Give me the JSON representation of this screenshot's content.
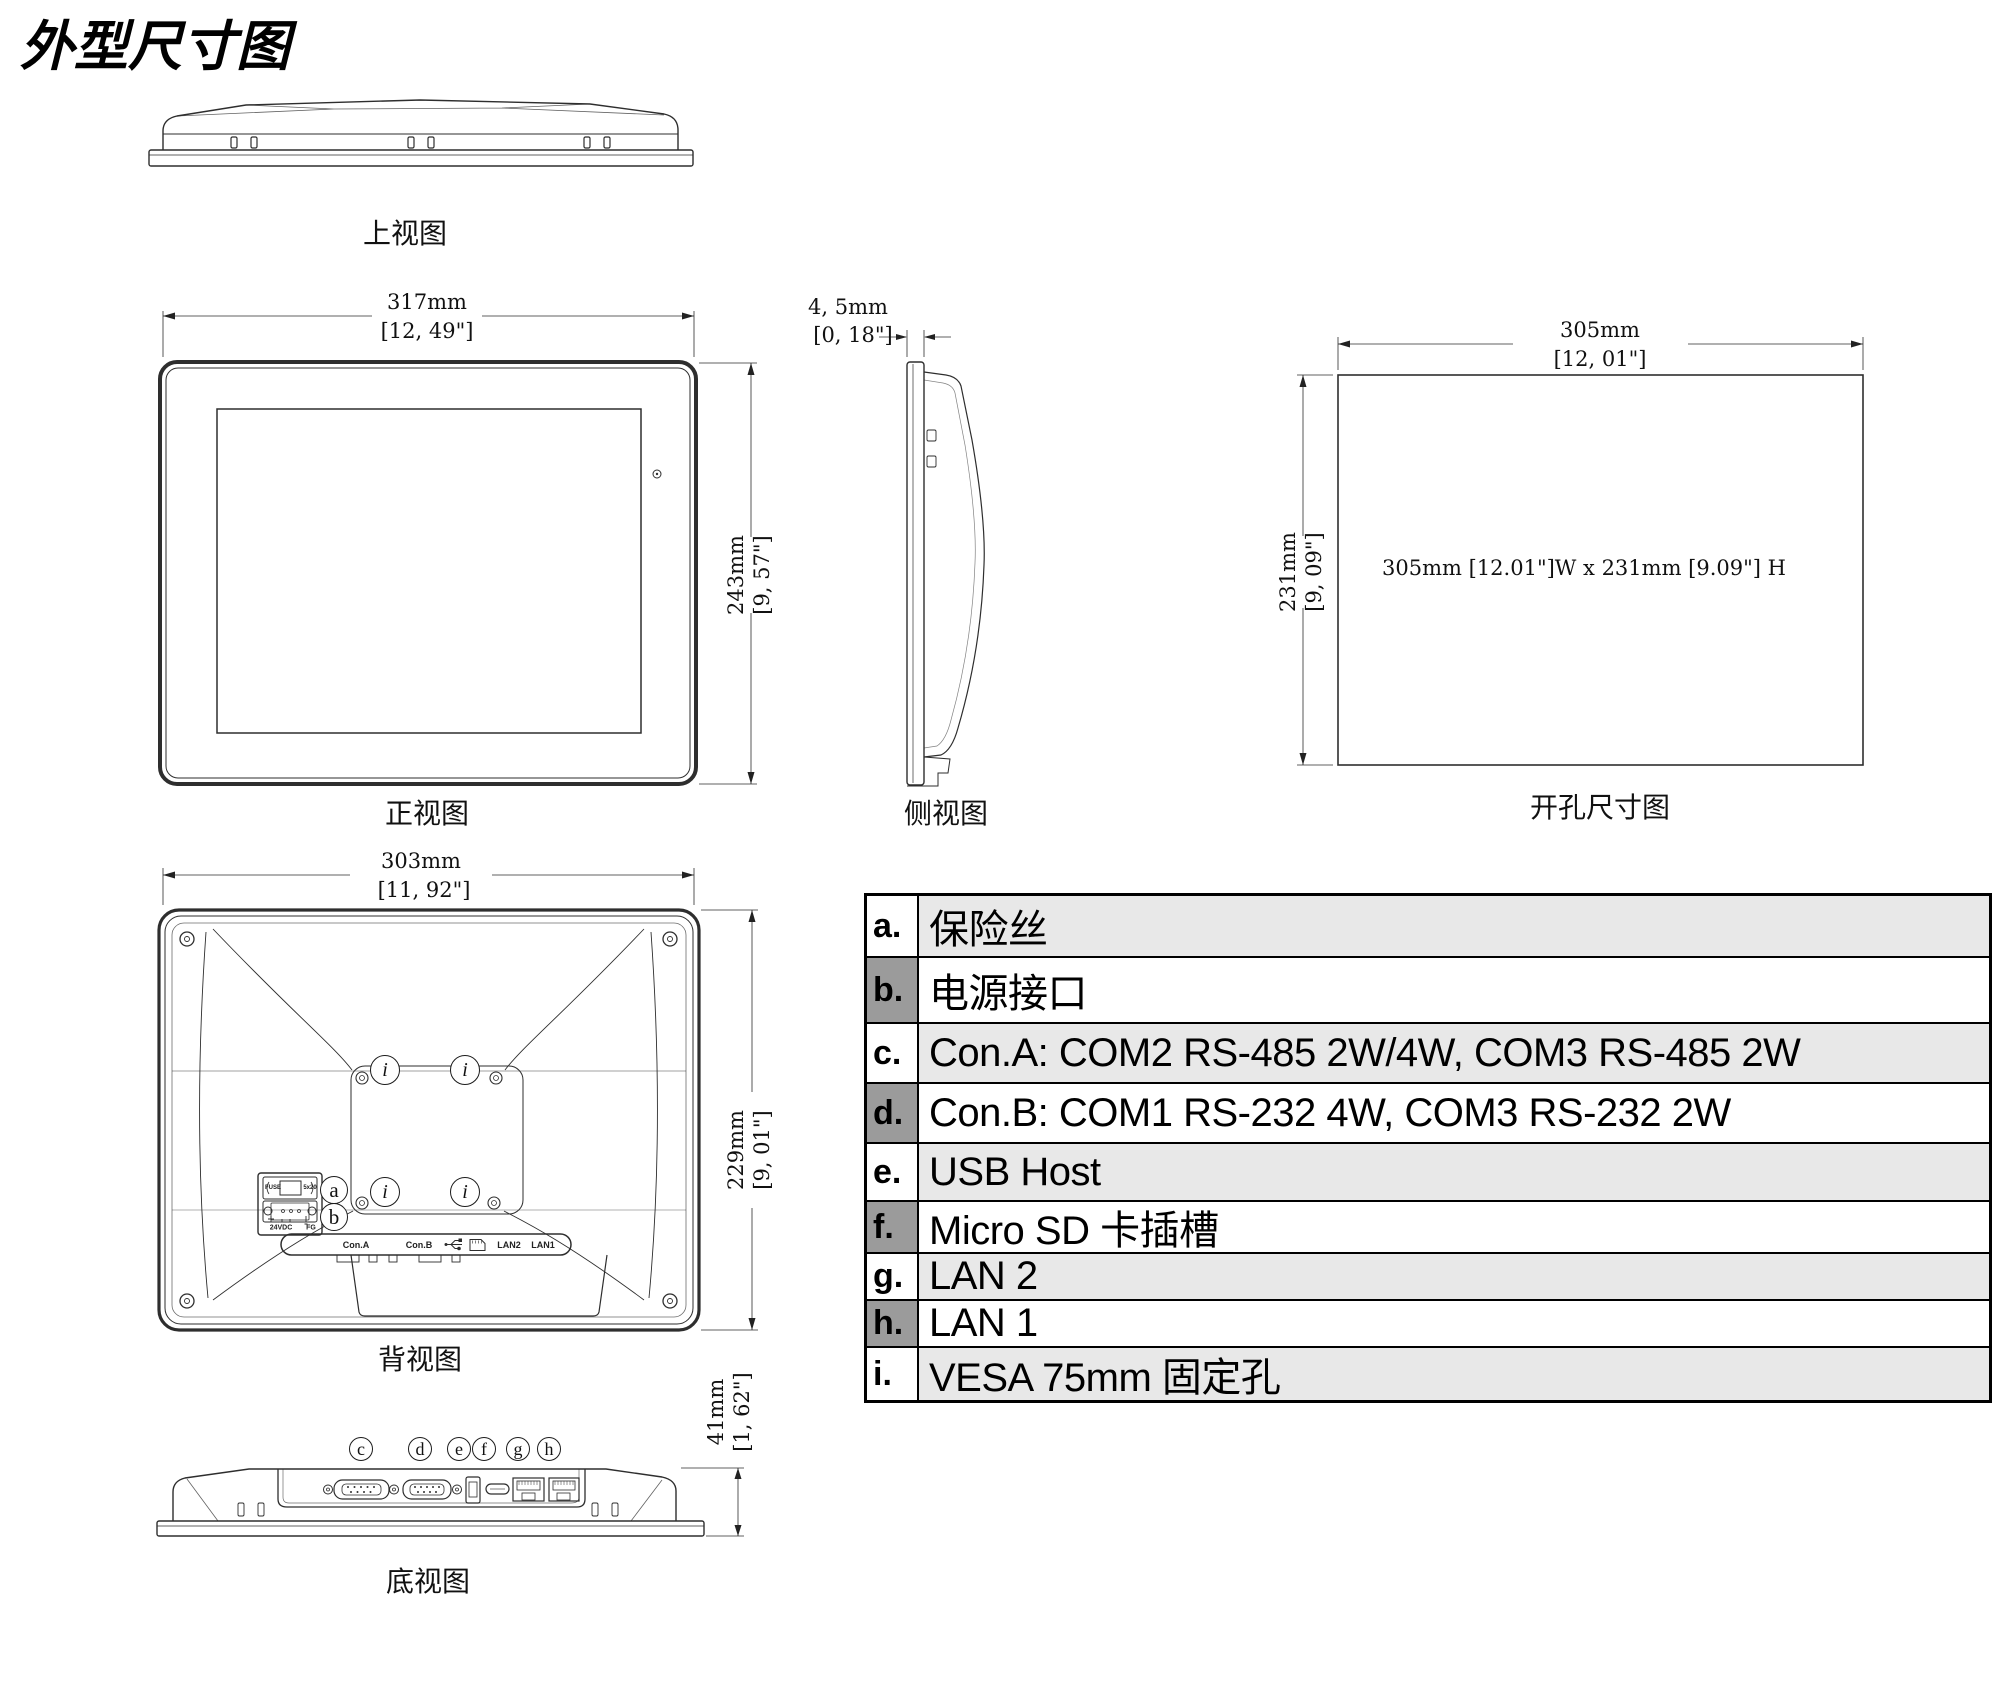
{
  "title": "外型尺寸图",
  "views": {
    "top": {
      "label": "上视图"
    },
    "front": {
      "label": "正视图",
      "width_mm": "317mm",
      "width_in": "[12, 49\"]",
      "height_mm": "243mm",
      "height_in": "[9, 57\"]"
    },
    "side": {
      "label": "侧视图",
      "depth_mm": "4, 5mm",
      "depth_in": "[0, 18\"]"
    },
    "cutout": {
      "label": "开孔尺寸图",
      "width_mm": "305mm",
      "width_in": "[12, 01\"]",
      "height_mm": "231mm",
      "height_in": "[9, 09\"]",
      "note": "305mm [12.01\"]W x 231mm [9.09\"] H"
    },
    "rear": {
      "label": "背视图",
      "width_mm": "303mm",
      "width_in": "[11, 92\"]",
      "height_mm": "229mm",
      "height_in": "[9, 01\"]",
      "fuse_label": "FUSE",
      "fuse_size": "5x20",
      "power_voltage": "24VDC",
      "power_ground": "FG",
      "strip": {
        "con_a": "Con.A",
        "con_b": "Con.B",
        "lan2": "LAN2",
        "lan1": "LAN1"
      }
    },
    "bottom": {
      "label": "底视图",
      "height_mm": "41mm",
      "height_in": "[1, 62\"]"
    }
  },
  "callouts": {
    "a": "a",
    "b": "b",
    "c": "c",
    "d": "d",
    "e": "e",
    "f": "f",
    "g": "g",
    "h": "h",
    "i": "i"
  },
  "legend": {
    "rows": [
      {
        "key": "a.",
        "text": "保险丝"
      },
      {
        "key": "b.",
        "text": "电源接口"
      },
      {
        "key": "c.",
        "text": "Con.A: COM2 RS-485 2W/4W, COM3 RS-485 2W"
      },
      {
        "key": "d.",
        "text": "Con.B: COM1 RS-232 4W, COM3 RS-232 2W"
      },
      {
        "key": "e.",
        "text": "USB Host"
      },
      {
        "key": "f.",
        "text": "Micro SD 卡插槽"
      },
      {
        "key": "g.",
        "text": "LAN 2"
      },
      {
        "key": "h.",
        "text": "LAN 1"
      },
      {
        "key": "i.",
        "text": "VESA 75mm 固定孔"
      }
    ]
  }
}
